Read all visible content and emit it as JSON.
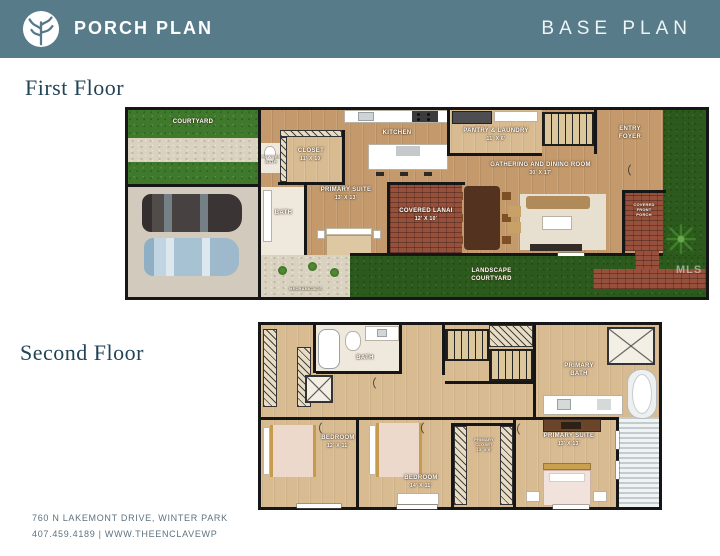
{
  "header": {
    "brand": "PORCH PLAN",
    "plan": "BASE PLAN"
  },
  "titles": {
    "first_floor": "First Floor",
    "second_floor": "Second Floor"
  },
  "footer": {
    "line1": "760 N LAKEMONT DRIVE, WINTER PARK",
    "line2": "407.459.4189 | WWW.THEENCLAVEWP"
  },
  "watermark": "MLS",
  "colors": {
    "header_bg": "#587b8a",
    "title_text": "#234457",
    "grass": "#3f7a2c",
    "grass_dark": "#2c5a1d",
    "brick": "#96503c",
    "wood_first": "#c49a6c",
    "wood_second": "#d9bb92",
    "wall": "#161616"
  },
  "first_floor": {
    "courtyard": "COURTYARD",
    "powder_bath": {
      "l1": "POWDER",
      "l2": "BATH"
    },
    "closet": {
      "name": "CLOSET",
      "dims": "11' X 10'"
    },
    "bath": "BATH",
    "primary_suite": {
      "name": "PRIMARY SUITE",
      "dims": "13' X 13'"
    },
    "kitchen": "KITCHEN",
    "pantry": {
      "name": "PANTRY & LAUNDRY",
      "dims": "11' X 6'"
    },
    "gathering": {
      "name": "GATHERING AND DINING ROOM",
      "dims": "30' X 17'"
    },
    "entry": {
      "l1": "ENTRY",
      "l2": "FOYER"
    },
    "lanai": {
      "name": "COVERED LANAI",
      "dims": "12' X 10'"
    },
    "porch": {
      "l1": "COVERED",
      "l2": "FRONT",
      "l3": "PORCH"
    },
    "landscape": {
      "l1": "LANDSCAPE",
      "l2": "COURTYARD"
    },
    "mechanicals": "MECHANICAL'S"
  },
  "second_floor": {
    "bath": "BATH",
    "primary_bath": {
      "l1": "PRIMARY",
      "l2": "BATH"
    },
    "bedroom1": {
      "name": "BEDROOM",
      "dims": "12' X 11'"
    },
    "bedroom2": {
      "name": "BEDROOM",
      "dims": "14' X 11'"
    },
    "primary_closet": {
      "l1": "PRIMARY",
      "l2": "CLOSET",
      "l3": "13' X 8'"
    },
    "primary_suite": {
      "name": "PRIMARY SUITE",
      "dims": "13' X 13'"
    }
  }
}
